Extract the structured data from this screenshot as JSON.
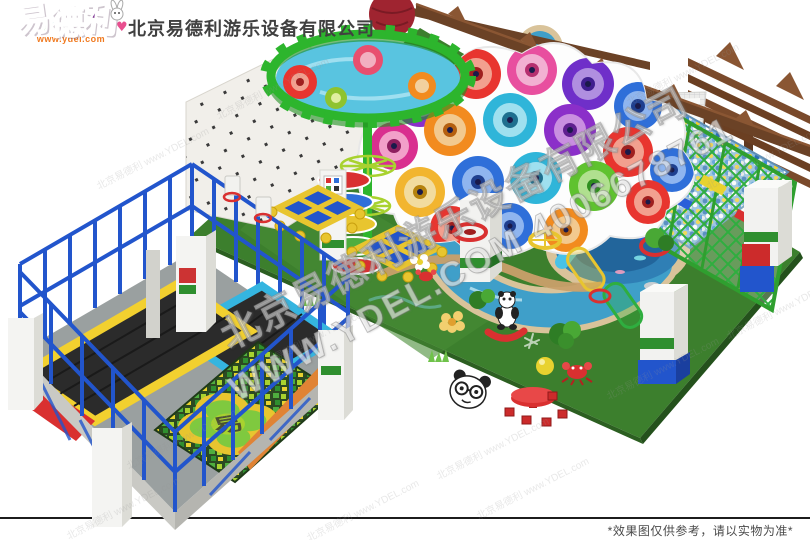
{
  "header": {
    "logo": {
      "char_1": "易",
      "char_2": "德",
      "char_3": "利",
      "url_label": "www.ydel.com",
      "heart_glyph": "♥",
      "colors": {
        "char_1": "#3bb52e",
        "char_2": "#2fa8a8",
        "char_3": "#7a2f8f",
        "url": "#f07a20"
      }
    },
    "company_name": "北京易德利游乐设备有限公司"
  },
  "watermarks": {
    "company_line": "北京易德利游乐设备有限公司",
    "site_phone_line": "WWW.YDEL.COM 4006678761",
    "small_line": "北京易德利 www.YDEL.com"
  },
  "scene": {
    "description": "indoor-playground-3d-render",
    "trampoline_logo_char": "易",
    "colors": {
      "floor_green": "#3c7f2d",
      "river_blue": "#3f9fc9",
      "rail_blue": "#2255cc",
      "fence_green": "#2fae3f",
      "pergola_brown": "#6b4226",
      "ring_green": "#2db52d",
      "mat_yellow": "#f2d02f",
      "mat_cyan": "#35b5e0"
    }
  },
  "footer": {
    "disclaimer": "*效果图仅供参考，请以实物为准*"
  }
}
